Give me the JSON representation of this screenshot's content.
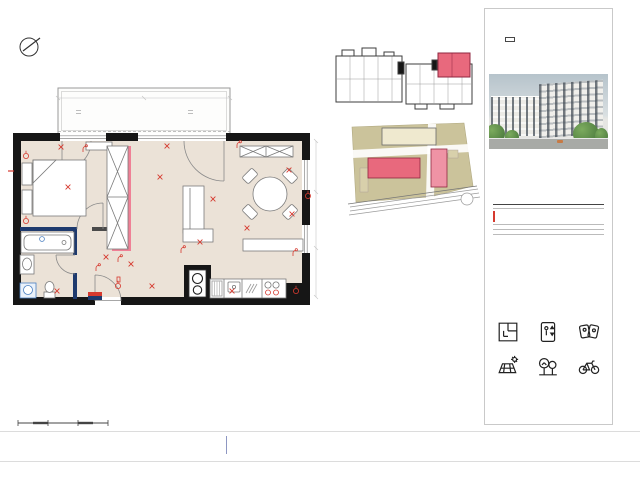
{
  "compass": {
    "label": "N"
  },
  "titles": {
    "situational": "PLAN SYTUACYJNY",
    "estate": "PLAN OSIEDLA",
    "legend": "LEGENDA"
  },
  "floor_plan": {
    "balkon_name": "Balkon",
    "balkon_area": "8.63",
    "pokoj_name": "Pokój",
    "pokoj_area": "11.24",
    "aneks_name": "Pokój z aneksem",
    "aneks_area": "28.20",
    "lazienka_name": "Łazienka",
    "lazienka_area": "4.46",
    "hol_name": "Hol",
    "hol_area": "6.91",
    "scale_ticks": [
      "0",
      "1",
      "2",
      "3 m"
    ]
  },
  "estate_map": {
    "building_a": "A",
    "building_b": "B",
    "building_c": "C",
    "street": "ul. Unii Lubelskiej"
  },
  "legend_items": [
    {
      "sym": "wall-black",
      "text": "Ściana konstrukcyjna"
    },
    {
      "sym": "wall-black",
      "text": "Ściana szachtu"
    },
    {
      "sym": "wall-navy",
      "text": "Ściana z możliwością zmiany lokalizacji gr. 10cm (kolor granatowy)"
    },
    {
      "sym": "wall-pink",
      "text": "Ściana działowa nadająca się do demontażu gr. 8cm (kolor różowy)"
    },
    {
      "sym": "light-x",
      "text": "Wypust oświetleniowy sufitowy"
    },
    {
      "sym": "switch-1",
      "text": "Łącznik pojedynczy 10A/230V, IP20"
    },
    {
      "sym": "switch-2",
      "text": "Łącznik podwójny 10A/230V, IP20"
    },
    {
      "sym": "switch-stair",
      "text": "Łącznik schodowy 10A/230V, IP20"
    },
    {
      "sym": "socket-2",
      "text": "Gniazdo podwójne 16A/230V, IP20"
    },
    {
      "sym": "socket-1",
      "text": "Gniazdo pojedyncze 16A/230V, IP20"
    },
    {
      "sym": "socket-herm",
      "text": "Gniazdo pojedyncze hermetyczne 16A/230V, IP44"
    },
    {
      "sym": "socket-bath",
      "text": "Gniazdo łazienki 16A/230V, IP44 montaż na wysokości 20 cm, w osi lustra"
    },
    {
      "sym": "socket-washer",
      "text": "Gniazdo pralki 16A/230V, IP44 montaż na wysokości 110cm, w osi pralki"
    },
    {
      "sym": "socket-dryer",
      "text": "Gniazdo suszarki 16A/230V, IP44 montaż na wysokości 170cm, w osi pralki"
    },
    {
      "sym": "socket-hood",
      "text": "Gniazdo okapu 16A/230V, IP44 montaż na wysokości 200cm, odsunięcie 20 cm od osi kuchenki"
    },
    {
      "sym": "socket-2h",
      "text": "Gniazdo podwójne 16A/230V, IP55"
    },
    {
      "sym": "cable-box",
      "text": "Wypust kablowy 400V zak. puszką"
    },
    {
      "sym": "rtv-sat",
      "text": "Gniazdo RTV/SAT"
    },
    {
      "sym": "rj45",
      "text": "Gniazdo internetowe RJ45 kat. 5e"
    },
    {
      "sym": "bonding",
      "text": "Lokalne połączenie wyrównawcze"
    },
    {
      "sym": "intercom",
      "text": "Domofon, montaż na wysokości 1,3m"
    },
    {
      "sym": "board",
      "text": "Tablica mieszkaniowa"
    }
  ],
  "panel": {
    "logo": {
      "word1": "UNII",
      "word2": "LUBELSKIEJ",
      "numeral": "4"
    },
    "fields": [
      {
        "label": "LOKAL:",
        "value": "A/11"
      },
      {
        "label": "TYP:",
        "value": "2 POKOJE"
      },
      {
        "label": "KONDYGNACJA:",
        "value": "PIĘTRO 2"
      },
      {
        "label": "BUDYNEK:",
        "value": "ETAP I - BUDYNEK A"
      }
    ],
    "rooms": [
      {
        "no": "1.",
        "name": "Pokój z aneksem",
        "area": "28.20 m²"
      },
      {
        "no": "2.",
        "name": "Pokój",
        "area": "11.24 m²"
      },
      {
        "no": "3.",
        "name": "Hol",
        "area": "6.91 m²"
      },
      {
        "no": "4.",
        "name": "Łazienka",
        "area": "4.46 m²"
      }
    ],
    "usable": {
      "label": "POWIERZCHNIA UŻYTKOWA",
      "value": "50.81 m²"
    },
    "demolition": {
      "label": "Powierzchnia pod ściankami nadającymi się do demontażu",
      "value": "0.39 m²"
    },
    "contract": {
      "label": "POW. UMOWNA",
      "value": "51.20 m²"
    },
    "balcony": {
      "label": "BALKON",
      "value": "8.63 m²"
    },
    "footnote": "powierzchnia mieszkania liczona wg normy PN-ISO 9836:2022-07",
    "features": [
      {
        "icon": "floorplan-icon",
        "caption": "funkcjonalne układy mieszkań"
      },
      {
        "icon": "elevator-icon",
        "caption": "budynki z windą"
      },
      {
        "icon": "residents-club-icon",
        "caption": "klub mieszkańca"
      },
      {
        "icon": "solar-panel-icon",
        "caption": "ekologia fotowoltaika"
      },
      {
        "icon": "gardens-icon",
        "caption": "przydomowe ogródki i tarasy oraz przestronne balkony"
      },
      {
        "icon": "bike-rack-icon",
        "caption": "stojaki rowerowe"
      }
    ]
  },
  "footer": {
    "disclaimer": "NINIEJSZE DANE SĄ POGLĄDOWE I MOGĄ ODBIEGAĆ OD OSTATECZNEGO PROJEKTU REALIZACYJNEGO",
    "brand": "AGROBEX",
    "website": "www.agrobex.pl",
    "phone": "tel. 61 84 64 060",
    "office_label": "Biuro sprzedaży mieszkań:",
    "office_value": "Poznań, ul. Kochanowskiego 7"
  },
  "colors": {
    "accent_pink": "#e8697d",
    "wall_navy": "#1e3a6e",
    "brand_navy": "#2e3d8f",
    "symbol_red": "#d63a2f"
  }
}
